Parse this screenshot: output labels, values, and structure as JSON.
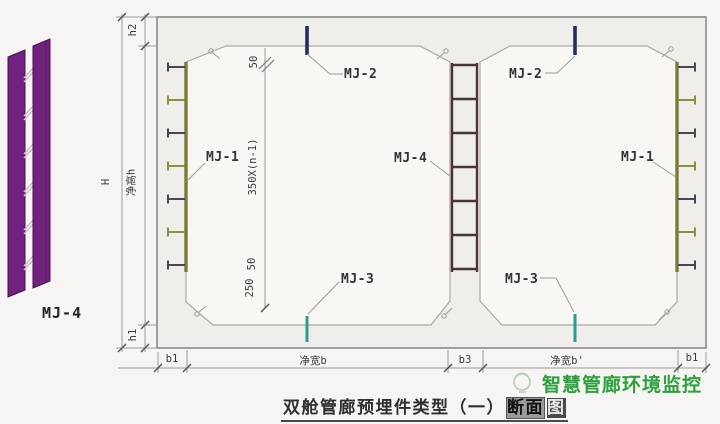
{
  "detail_view": {
    "label": "MJ-4"
  },
  "callouts": {
    "mj1": "MJ-1",
    "mj2": "MJ-2",
    "mj3": "MJ-3",
    "mj4": "MJ-4"
  },
  "dimensions": {
    "total_height": "H",
    "top_slab": "h2",
    "clear_height": "净高h",
    "bottom_slab": "h1",
    "spacing_top": "50",
    "spacing_mid": "350X(n-1)",
    "spacing_low": "50",
    "spacing_bot": "250",
    "bottom": {
      "b1_left": "b1",
      "clear_width_left": "净宽b",
      "b3": "b3",
      "clear_width_right": "净宽b'",
      "b1_right": "b1"
    }
  },
  "title": {
    "main": "双舱管廊预埋件类型（一）",
    "hl1": "断面",
    "hl2": "图"
  },
  "watermark": {
    "text": "智慧管廊环境监控"
  },
  "colors": {
    "mj1_bar": "#7d7b3a",
    "stud_dark": "#474752",
    "stud_olive": "#8f8d3f",
    "mj2_tick": "#232d5e",
    "mj3_tick": "#2a9d8f",
    "mj4_ladder": "#4a3434",
    "detail_purple": "#71227e",
    "detail_edge": "#451252",
    "detail_rung": "#cdbdd4",
    "watermark_green": "#2ba03c"
  }
}
